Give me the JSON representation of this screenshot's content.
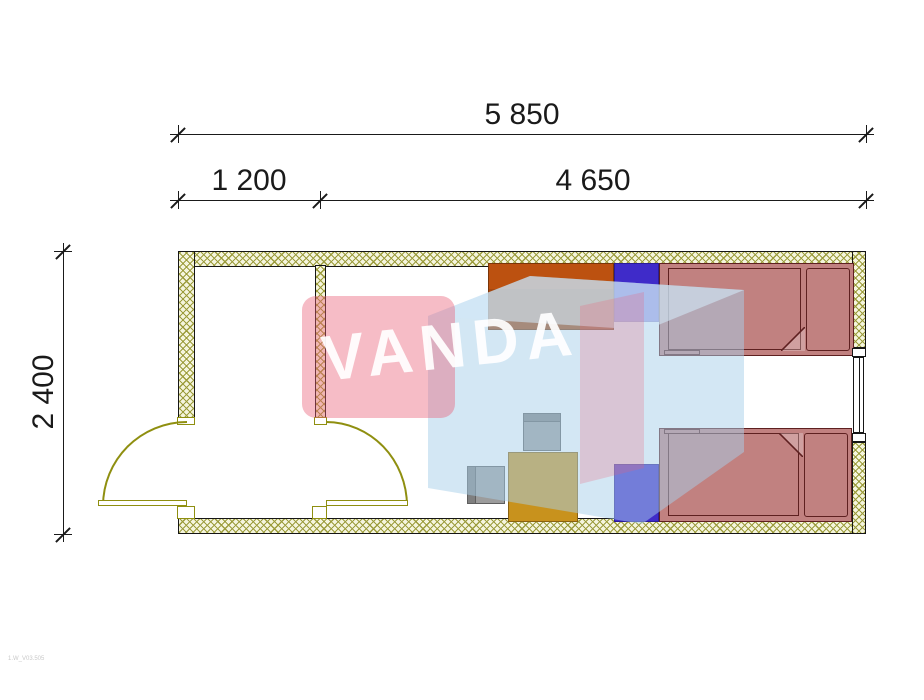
{
  "dimensions": {
    "total_width": "5 850",
    "vestibule_width": "1 200",
    "room_width": "4 650",
    "height": "2 400"
  },
  "watermark": {
    "text": "VANDA"
  },
  "footer": {
    "drawing_code": "1.W_V03.505"
  },
  "palette": {
    "wall_fill": "#F5F5DE",
    "wall_hatch": "#9C9C3C",
    "wall_line": "#161616",
    "door": "#8F8F10",
    "bed_fill": "#C18180",
    "bed_line": "#5E2020",
    "nightstand": "#3F2BC9",
    "wardrobe": "#BC5110",
    "wardrobe_line": "#7A3508",
    "table_fill": "#C8921D",
    "table_line": "#8A6210",
    "chair_fill": "#9C9C9C",
    "chair_line": "#5F5F5F",
    "dim_color": "#1A1A1A",
    "wm_pink": "#EA6076",
    "wm_blue": "#A7D0EA",
    "wm_blue_light": "#D2E8F6"
  }
}
